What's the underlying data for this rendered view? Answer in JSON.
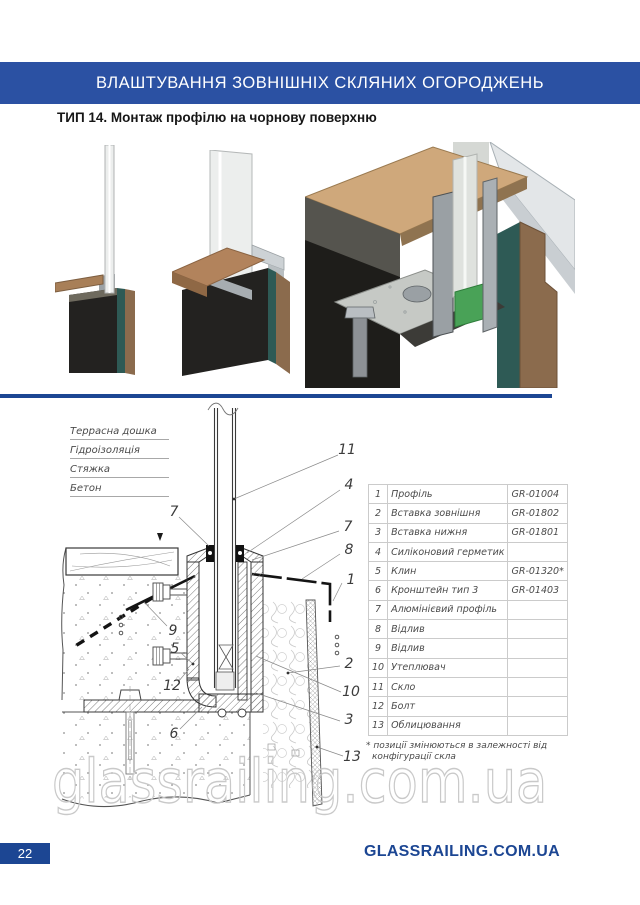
{
  "header": {
    "title": "ВЛАШТУВАННЯ ЗОВНІШНІХ СКЛЯНИХ ОГОРОДЖЕНЬ"
  },
  "section": {
    "title": "ТИП 14. Монтаж профілю на чорнову поверхню"
  },
  "colors": {
    "band": "#2b51a3",
    "accent": "#1c4693"
  },
  "drawing": {
    "labels": [
      "Террасна дошка",
      "Гідроізоляція",
      "Стяжка",
      "Бетон"
    ],
    "callouts": [
      "7",
      "11",
      "4",
      "7",
      "8",
      "1",
      "2",
      "10",
      "3",
      "13",
      "9",
      "5",
      "12",
      "6"
    ]
  },
  "table": {
    "rows": [
      {
        "num": "1",
        "name": "Профіль",
        "code": "GR-01004"
      },
      {
        "num": "2",
        "name": "Вставка зовнішня",
        "code": "GR-01802"
      },
      {
        "num": "3",
        "name": "Вставка нижня",
        "code": "GR-01801"
      },
      {
        "num": "4",
        "name": "Силіконовий герметик",
        "code": ""
      },
      {
        "num": "5",
        "name": "Клин",
        "code": "GR-01320*"
      },
      {
        "num": "6",
        "name": "Кронштейн тип 3",
        "code": "GR-01403"
      },
      {
        "num": "7",
        "name": "Алюмінієвий профіль",
        "code": ""
      },
      {
        "num": "8",
        "name": "Відлив",
        "code": ""
      },
      {
        "num": "9",
        "name": "Відлив",
        "code": ""
      },
      {
        "num": "10",
        "name": "Утеплювач",
        "code": ""
      },
      {
        "num": "11",
        "name": "Скло",
        "code": ""
      },
      {
        "num": "12",
        "name": "Болт",
        "code": ""
      },
      {
        "num": "13",
        "name": "Облицювання",
        "code": ""
      }
    ]
  },
  "note": {
    "line1": "* позиції змінюються в залежності від",
    "line2": "конфігурації скла"
  },
  "watermark": {
    "text": "glassrailing.com.ua"
  },
  "footer": {
    "page": "22",
    "site": "GLASSRAILING.COM.UA"
  }
}
